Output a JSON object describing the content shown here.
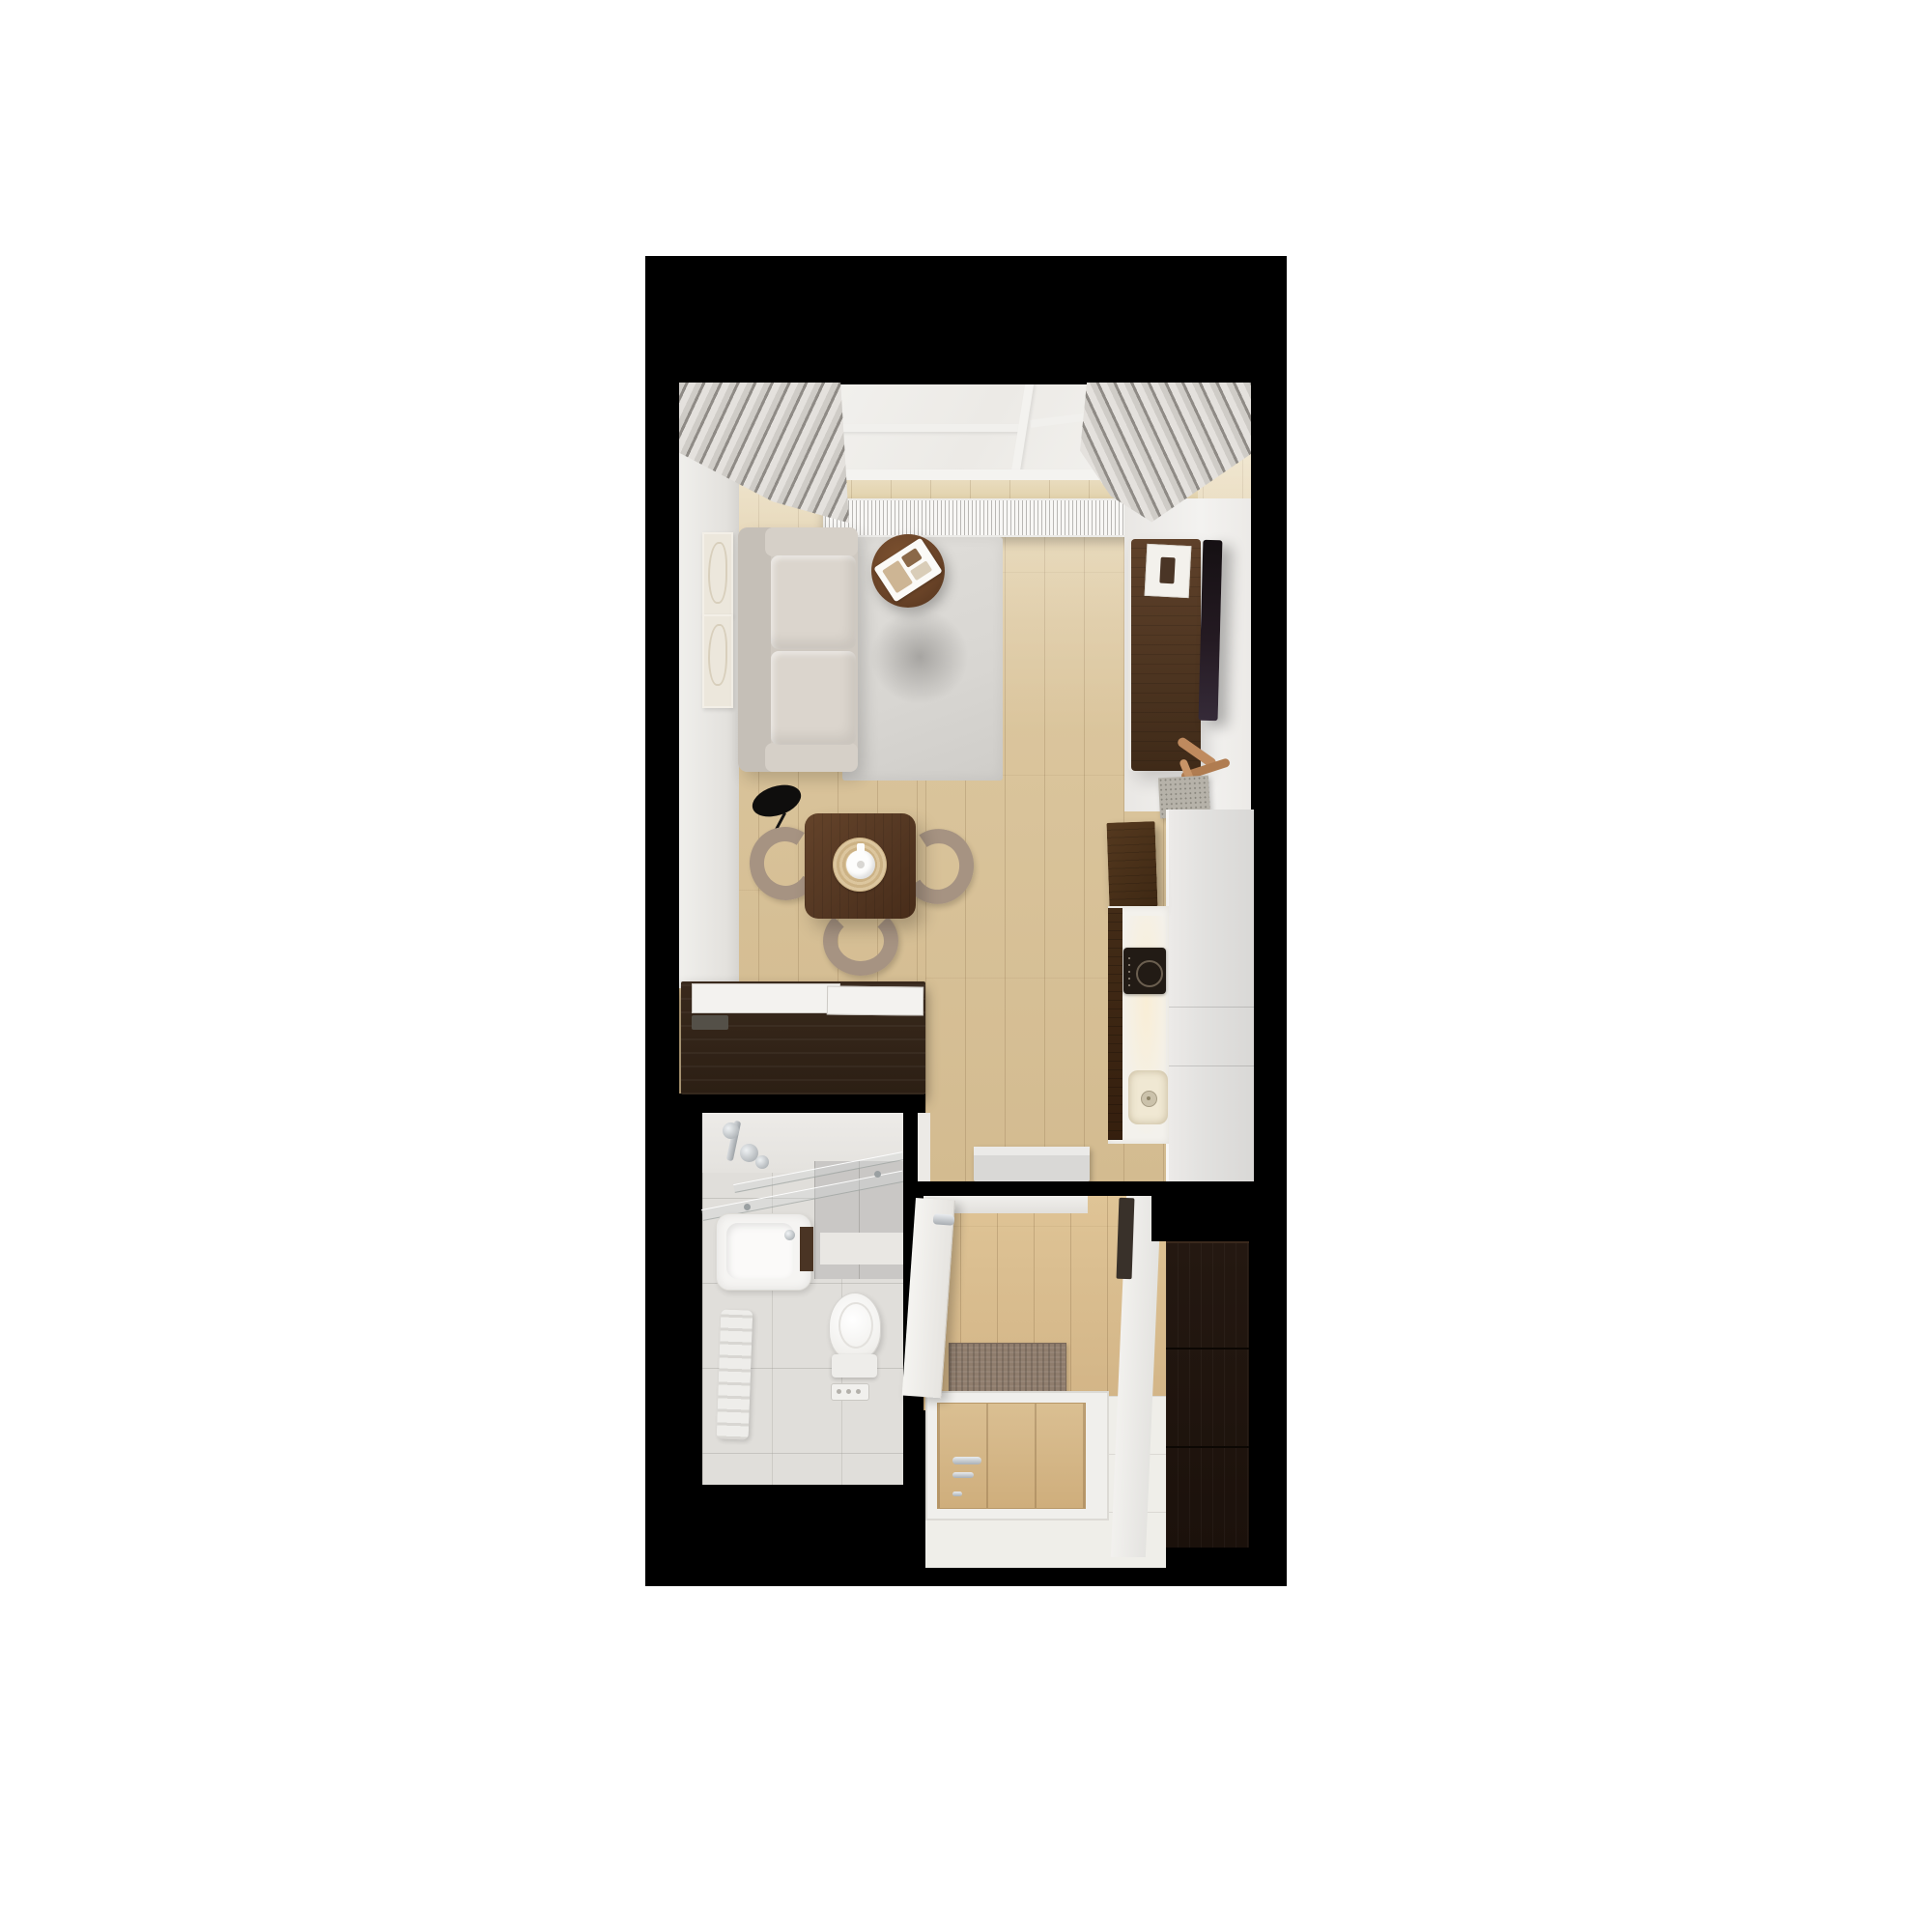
{
  "scene": {
    "type": "apartment-floor-plan-3d-render",
    "view": "top-down dollhouse render of a studio apartment",
    "background_color": "#ffffff",
    "wall_color": "#000000"
  },
  "palette": {
    "wood_floor": "#d8c29a",
    "hall_wood_floor": "#d2b486",
    "dark_walnut_furniture": "#3f2a18",
    "sofa_upholstery": "#d6d0c8",
    "rug": "#d8d6d2",
    "curtains": "#b5b1ac",
    "kitchen_counter": "#f3f1ec",
    "counter_gray_run": "#e2e1df",
    "cooktop": "#221b15",
    "bathroom_tile": "#e0deda",
    "bathroom_wall_tile": "#c9c7c5",
    "chrome_fixtures": "#aab0b5",
    "doormat": "#8f7d6d",
    "entry_door_wood": "#cfae7c",
    "wardrobe": "#1f1410",
    "chair_fabric": "#a69382"
  },
  "rooms": [
    {
      "name": "living-room-with-kitchen",
      "features": [
        "balcony-window",
        "curtains",
        "radiator",
        "wall-artworks"
      ],
      "furniture": [
        "sofa",
        "area-rug",
        "round-coffee-table-with-tray",
        "floor-lamp",
        "dining-table",
        "three-dining-chairs",
        "teapot-on-placemat",
        "tv-cabinet",
        "wall-mounted-tv",
        "driftwood-sculpture",
        "tall-kitchen-cabinet",
        "kitchen-counter-with-cooktop-and-sink",
        "counter-run-along-right-wall",
        "sideboard-with-white-top",
        "bench-block"
      ]
    },
    {
      "name": "bathroom",
      "fixtures": [
        "shower-glass-panels",
        "shower-faucet",
        "washbasin-with-tap",
        "vanity-edge",
        "towel-radiator",
        "toilet",
        "linear-floor-drain",
        "gray-wall-tiles"
      ]
    },
    {
      "name": "entry-hall",
      "furniture": [
        "doormat",
        "entry-door-with-chrome-handle",
        "tall-dark-wardrobe",
        "wall-mirror",
        "open-white-bathroom-door"
      ]
    }
  ]
}
